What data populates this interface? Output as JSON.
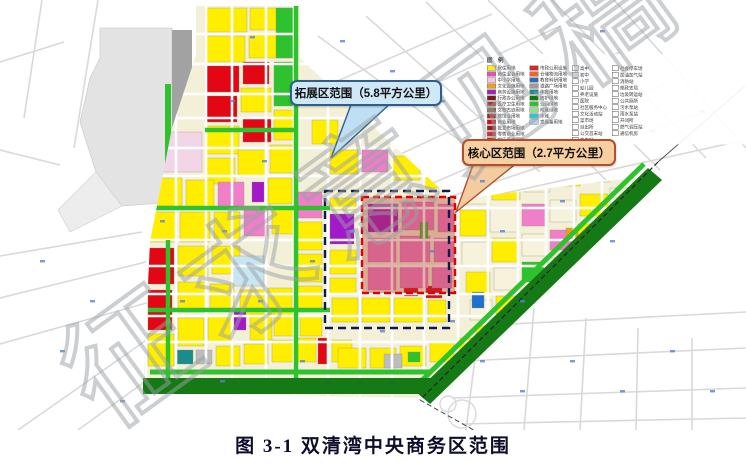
{
  "figure": {
    "caption": "图 3-1 双清湾中央商务区范围"
  },
  "callouts": {
    "expansion": {
      "label": "拓展区范围（5.8平方公里）",
      "area_km2": "5.8"
    },
    "core": {
      "label": "核心区范围（2.7平方公里）",
      "area_km2": "2.7"
    }
  },
  "watermark": {
    "text": "征求意见稿",
    "color": "#9aa0a6"
  },
  "legend": {
    "title": "图 例",
    "col1": [
      {
        "color": "#FFF200",
        "label": "居住用地"
      },
      {
        "color": "#E94FB0",
        "label": "商住混合用地"
      },
      {
        "color": "#F6C6DE",
        "label": "中小学用地"
      },
      {
        "color": "#F59B14",
        "label": "文化设施用地"
      },
      {
        "color": "#9B26B6",
        "label": "商务设施用地"
      },
      {
        "color": "#7A1A1A",
        "label": "行政办公用地"
      },
      {
        "color": "#A83232",
        "label": "医疗卫生用地"
      },
      {
        "color": "#8B5A2B",
        "label": "文物古迹用地"
      },
      {
        "color": "#B71C1C",
        "label": "旅馆业用地"
      },
      {
        "color": "#E30613",
        "label": "商业用地"
      },
      {
        "color": "#9E1B1B",
        "label": "批发市场用地"
      },
      {
        "color": "#D32F2F",
        "label": "零售商业用地"
      },
      {
        "color": "#C62828",
        "label": "娱乐康体用地"
      }
    ],
    "col2": [
      {
        "color": "#D42A2A",
        "label": "市政公用设施"
      },
      {
        "color": "#F26522",
        "label": "仓储物流用地"
      },
      {
        "color": "#2B6CB8",
        "label": "教育科研用地"
      },
      {
        "color": "#9C9C9C",
        "label": "道路广场用地"
      },
      {
        "color": "#1A8C8C",
        "label": "体育用地"
      },
      {
        "color": "#0E7A0E",
        "label": "防护绿地"
      },
      {
        "color": "#2EC22E",
        "label": "公园绿地"
      },
      {
        "color": "#8FE08F",
        "label": "附属绿地"
      },
      {
        "color": "#27C8C8",
        "label": "水域"
      },
      {
        "color": "#AFD8F2",
        "label": "发展备用地"
      }
    ],
    "col3": [
      "高中",
      "初中",
      "小学",
      "幼儿园",
      "养老设施",
      "医院",
      "社区服务中心",
      "文化活动站",
      "菜市场",
      "派出所",
      "公交首末站",
      "变电站"
    ],
    "col4": [
      "社会停车场",
      "加油加气站",
      "消防站",
      "邮政支局",
      "垃圾转运站",
      "公共厕所",
      "污水泵站",
      "雨水泵站",
      "开闭所",
      "燃气调压站",
      "通信机房"
    ]
  },
  "map": {
    "palette": {
      "Y": "#FFEE00",
      "R": "#E30613",
      "P": "#F07EC8",
      "LP": "#F3D5E8",
      "M": "#A318C9",
      "O": "#F59B14",
      "C": "#C8E6F0",
      "B": "#1F6FD0",
      "T": "#1A8C8C",
      "G": "#2EC22E",
      "DG": "#157A15",
      "K": "#BDBDBD",
      "CR": "#F6F2DC",
      "base": "#F4F0D8",
      "overlay": "#B03A2E",
      "navy": "#0B1B4A",
      "red_dash": "#E00000",
      "faint": "#d9d9d9",
      "tick": "#5B7FD4",
      "station": "#e3e3e3",
      "rail_strip": "#a2a2a2"
    },
    "planned_polygon": [
      [
        196,
        6
      ],
      [
        300,
        6
      ],
      [
        300,
        58
      ],
      [
        452,
        200
      ],
      [
        640,
        177
      ],
      [
        418,
        398
      ],
      [
        143,
        392
      ],
      [
        150,
        242
      ],
      [
        172,
        128
      ],
      [
        196,
        55
      ]
    ],
    "expansion_rect": [
      325,
      191,
      124,
      137
    ],
    "core_rect": [
      362,
      197,
      93,
      96
    ],
    "pointer_expansion": [
      [
        352,
        102
      ],
      [
        392,
        102
      ],
      [
        331,
        158
      ]
    ],
    "pointer_core": [
      [
        474,
        162
      ],
      [
        518,
        162
      ],
      [
        456,
        212
      ]
    ],
    "band_diagonal": [
      [
        648,
        168
      ],
      [
        662,
        180
      ],
      [
        430,
        404
      ],
      [
        416,
        392
      ]
    ],
    "band_bottom": [
      143,
      378,
      292,
      16
    ],
    "bright_edge_diag": [
      644,
      164,
      412,
      390
    ],
    "bright_edge_bottom": [
      150,
      372,
      430,
      372
    ],
    "railway": {
      "main": [
        658,
        162,
        420,
        400
      ],
      "ext_top": [
        658,
        162,
        745,
        86
      ],
      "ext_bottom": [
        420,
        400,
        545,
        470
      ]
    },
    "station_polygon": [
      [
        100,
        28
      ],
      [
        172,
        28
      ],
      [
        172,
        202
      ],
      [
        122,
        206
      ],
      [
        96,
        172
      ],
      [
        80,
        122
      ],
      [
        90,
        78
      ],
      [
        100,
        58
      ]
    ],
    "station_tail": [
      [
        96,
        172
      ],
      [
        122,
        206
      ],
      [
        70,
        232
      ],
      [
        58,
        210
      ]
    ],
    "station_rail_rect": [
      172,
      30,
      20,
      172
    ],
    "station_green_rect": [
      165,
      84,
      6,
      116
    ],
    "road_v_x": [
      146,
      176,
      206,
      232,
      266,
      294,
      328,
      360,
      392,
      424,
      458,
      488,
      518,
      546,
      574,
      602,
      630
    ],
    "road_h_y": [
      34,
      64,
      94,
      118,
      148,
      176,
      208,
      240,
      266,
      294,
      316,
      342
    ],
    "green_strips": [
      [
        296,
        6,
        296,
        390
      ],
      [
        168,
        240,
        168,
        390
      ],
      [
        205,
        130,
        298,
        130
      ],
      [
        148,
        208,
        330,
        208
      ],
      [
        148,
        310,
        330,
        310
      ]
    ],
    "parcels": [
      [
        205,
        8,
        42,
        24,
        "Y"
      ],
      [
        250,
        8,
        44,
        22,
        "Y"
      ],
      [
        205,
        36,
        40,
        26,
        "Y"
      ],
      [
        249,
        34,
        44,
        24,
        "Y"
      ],
      [
        276,
        8,
        18,
        50,
        "G"
      ],
      [
        205,
        66,
        34,
        26,
        "R"
      ],
      [
        243,
        62,
        26,
        22,
        "R"
      ],
      [
        205,
        96,
        32,
        26,
        "R"
      ],
      [
        241,
        88,
        30,
        24,
        "Y"
      ],
      [
        274,
        62,
        20,
        44,
        "G"
      ],
      [
        205,
        126,
        34,
        28,
        "Y"
      ],
      [
        243,
        118,
        28,
        24,
        "R"
      ],
      [
        274,
        110,
        22,
        30,
        "Y"
      ],
      [
        160,
        132,
        42,
        40,
        "LP"
      ],
      [
        205,
        158,
        30,
        26,
        "Y"
      ],
      [
        238,
        150,
        28,
        26,
        "Y"
      ],
      [
        270,
        145,
        26,
        28,
        "Y"
      ],
      [
        152,
        178,
        30,
        28,
        "Y"
      ],
      [
        186,
        180,
        28,
        28,
        "Y"
      ],
      [
        218,
        182,
        26,
        26,
        "P"
      ],
      [
        268,
        178,
        24,
        26,
        "Y"
      ],
      [
        252,
        182,
        12,
        20,
        "M"
      ],
      [
        148,
        212,
        28,
        30,
        "Y"
      ],
      [
        180,
        212,
        30,
        30,
        "Y"
      ],
      [
        214,
        212,
        26,
        28,
        "Y"
      ],
      [
        244,
        210,
        24,
        26,
        "P"
      ],
      [
        272,
        208,
        24,
        26,
        "Y"
      ],
      [
        148,
        248,
        26,
        36,
        "R"
      ],
      [
        148,
        290,
        24,
        40,
        "R"
      ],
      [
        178,
        246,
        30,
        30,
        "Y"
      ],
      [
        212,
        246,
        28,
        28,
        "Y"
      ],
      [
        232,
        256,
        32,
        30,
        "C"
      ],
      [
        178,
        282,
        28,
        30,
        "Y"
      ],
      [
        210,
        284,
        24,
        26,
        "Y"
      ],
      [
        240,
        290,
        26,
        26,
        "Y"
      ],
      [
        268,
        288,
        24,
        26,
        "Y"
      ],
      [
        148,
        334,
        26,
        32,
        "Y"
      ],
      [
        178,
        318,
        26,
        28,
        "Y"
      ],
      [
        208,
        316,
        24,
        26,
        "Y"
      ],
      [
        234,
        310,
        12,
        20,
        "M"
      ],
      [
        250,
        314,
        22,
        26,
        "Y"
      ],
      [
        274,
        312,
        22,
        24,
        "Y"
      ],
      [
        175,
        350,
        18,
        14,
        "T"
      ],
      [
        196,
        350,
        16,
        14,
        "K"
      ],
      [
        216,
        346,
        24,
        20,
        "Y"
      ],
      [
        244,
        344,
        24,
        20,
        "Y"
      ],
      [
        272,
        340,
        22,
        22,
        "Y"
      ],
      [
        298,
        338,
        18,
        24,
        "Y"
      ],
      [
        318,
        338,
        10,
        26,
        "R"
      ],
      [
        332,
        340,
        20,
        22,
        "Y"
      ],
      [
        298,
        192,
        24,
        26,
        "P"
      ],
      [
        298,
        222,
        24,
        28,
        "Y"
      ],
      [
        298,
        254,
        24,
        28,
        "Y"
      ],
      [
        298,
        286,
        24,
        26,
        "Y"
      ],
      [
        300,
        316,
        22,
        20,
        "Y"
      ],
      [
        312,
        120,
        26,
        24,
        "Y"
      ],
      [
        330,
        150,
        28,
        24,
        "Y"
      ],
      [
        362,
        150,
        26,
        22,
        "P"
      ],
      [
        392,
        156,
        28,
        24,
        "Y"
      ],
      [
        424,
        168,
        24,
        20,
        "Y"
      ],
      [
        330,
        198,
        26,
        12,
        "Y"
      ],
      [
        330,
        214,
        24,
        30,
        "M"
      ],
      [
        330,
        250,
        26,
        24,
        "Y"
      ],
      [
        330,
        278,
        26,
        16,
        "Y"
      ],
      [
        332,
        298,
        26,
        24,
        "Y"
      ],
      [
        362,
        298,
        28,
        24,
        "Y"
      ],
      [
        394,
        298,
        30,
        24,
        "Y"
      ],
      [
        426,
        286,
        16,
        12,
        "R"
      ],
      [
        428,
        300,
        18,
        22,
        "Y"
      ],
      [
        368,
        204,
        30,
        28,
        "M"
      ],
      [
        402,
        202,
        32,
        28,
        "P"
      ],
      [
        438,
        204,
        16,
        28,
        "P"
      ],
      [
        368,
        238,
        28,
        24,
        "P"
      ],
      [
        400,
        236,
        30,
        26,
        "P"
      ],
      [
        434,
        238,
        20,
        24,
        "P"
      ],
      [
        368,
        266,
        28,
        24,
        "P"
      ],
      [
        400,
        266,
        28,
        22,
        "P"
      ],
      [
        432,
        266,
        20,
        22,
        "P"
      ],
      [
        404,
        288,
        14,
        8,
        "R"
      ],
      [
        420,
        222,
        8,
        18,
        "G"
      ],
      [
        462,
        180,
        26,
        24,
        "CR"
      ],
      [
        492,
        176,
        28,
        24,
        "Y"
      ],
      [
        524,
        170,
        26,
        22,
        "CR"
      ],
      [
        554,
        166,
        26,
        20,
        "Y"
      ],
      [
        584,
        162,
        26,
        20,
        "CR"
      ],
      [
        612,
        158,
        26,
        18,
        "Y"
      ],
      [
        558,
        166,
        10,
        12,
        "R"
      ],
      [
        460,
        210,
        26,
        26,
        "Y"
      ],
      [
        490,
        208,
        28,
        24,
        "CR"
      ],
      [
        522,
        204,
        24,
        22,
        "P"
      ],
      [
        550,
        200,
        26,
        22,
        "CR"
      ],
      [
        580,
        194,
        28,
        22,
        "Y"
      ],
      [
        610,
        188,
        24,
        20,
        "CR"
      ],
      [
        462,
        242,
        26,
        24,
        "CR"
      ],
      [
        492,
        238,
        26,
        24,
        "Y"
      ],
      [
        522,
        234,
        24,
        22,
        "CR"
      ],
      [
        550,
        230,
        24,
        20,
        "P"
      ],
      [
        578,
        224,
        26,
        22,
        "Y"
      ],
      [
        606,
        218,
        22,
        20,
        "CR"
      ],
      [
        566,
        228,
        12,
        10,
        "O"
      ],
      [
        466,
        272,
        24,
        22,
        "Y"
      ],
      [
        494,
        268,
        24,
        22,
        "CR"
      ],
      [
        522,
        262,
        22,
        20,
        "G"
      ],
      [
        548,
        258,
        24,
        20,
        "CR"
      ],
      [
        574,
        252,
        24,
        20,
        "Y"
      ],
      [
        600,
        248,
        20,
        18,
        "CR"
      ],
      [
        470,
        300,
        22,
        20,
        "CR"
      ],
      [
        496,
        296,
        22,
        18,
        "Y"
      ],
      [
        522,
        290,
        20,
        18,
        "CR"
      ],
      [
        546,
        286,
        22,
        18,
        "Y"
      ],
      [
        472,
        292,
        12,
        16,
        "B"
      ],
      [
        476,
        326,
        20,
        16,
        "Y"
      ],
      [
        500,
        322,
        20,
        16,
        "CR"
      ],
      [
        524,
        316,
        18,
        14,
        "Y"
      ],
      [
        338,
        348,
        28,
        20,
        "Y"
      ],
      [
        370,
        348,
        26,
        20,
        "Y"
      ],
      [
        400,
        346,
        26,
        20,
        "Y"
      ],
      [
        430,
        342,
        24,
        20,
        "Y"
      ],
      [
        458,
        338,
        24,
        18,
        "Y"
      ],
      [
        486,
        332,
        22,
        18,
        "Y"
      ],
      [
        384,
        354,
        18,
        14,
        "K"
      ],
      [
        408,
        352,
        12,
        10,
        "G"
      ]
    ],
    "faint_roads": [
      [
        312,
        92,
        492,
        14
      ],
      [
        330,
        132,
        560,
        26
      ],
      [
        362,
        172,
        620,
        52
      ],
      [
        398,
        198,
        668,
        82
      ],
      [
        446,
        198,
        706,
        112
      ],
      [
        492,
        196,
        745,
        140
      ],
      [
        318,
        36,
        470,
        148
      ],
      [
        366,
        16,
        540,
        172
      ],
      [
        426,
        2,
        606,
        180
      ],
      [
        488,
        0,
        660,
        170
      ],
      [
        552,
        0,
        706,
        158
      ],
      [
        614,
        0,
        746,
        148
      ],
      [
        482,
        302,
        466,
        430
      ],
      [
        534,
        308,
        524,
        430
      ],
      [
        586,
        318,
        580,
        430
      ],
      [
        638,
        328,
        636,
        430
      ],
      [
        692,
        338,
        692,
        430
      ],
      [
        434,
        328,
        746,
        312
      ],
      [
        442,
        362,
        746,
        348
      ],
      [
        452,
        398,
        746,
        388
      ],
      [
        462,
        424,
        746,
        418
      ],
      [
        0,
        298,
        146,
        262
      ],
      [
        0,
        344,
        150,
        302
      ],
      [
        18,
        430,
        158,
        332
      ],
      [
        78,
        430,
        172,
        362
      ],
      [
        0,
        256,
        142,
        232
      ],
      [
        42,
        0,
        24,
        118
      ],
      [
        98,
        0,
        74,
        148
      ],
      [
        0,
        62,
        64,
        42
      ],
      [
        0,
        150,
        60,
        165
      ]
    ],
    "interchange_circles": [
      [
        448,
        404,
        8
      ],
      [
        462,
        414,
        14
      ]
    ],
    "blue_ticks": [
      [
        250,
        36
      ],
      [
        230,
        100
      ],
      [
        262,
        160
      ],
      [
        222,
        230
      ],
      [
        258,
        300
      ],
      [
        350,
        230
      ],
      [
        310,
        260
      ],
      [
        430,
        250
      ],
      [
        500,
        230
      ],
      [
        560,
        200
      ],
      [
        610,
        240
      ],
      [
        480,
        180
      ],
      [
        520,
        300
      ],
      [
        450,
        320
      ],
      [
        380,
        330
      ],
      [
        300,
        360
      ],
      [
        220,
        380
      ],
      [
        180,
        300
      ],
      [
        160,
        220
      ],
      [
        340,
        40
      ],
      [
        390,
        70
      ],
      [
        440,
        100
      ],
      [
        490,
        130
      ],
      [
        540,
        60
      ],
      [
        600,
        30
      ],
      [
        650,
        130
      ],
      [
        700,
        110
      ],
      [
        480,
        360
      ],
      [
        520,
        390
      ],
      [
        570,
        360
      ],
      [
        620,
        390
      ],
      [
        670,
        350
      ],
      [
        710,
        390
      ],
      [
        90,
        300
      ],
      [
        60,
        350
      ],
      [
        120,
        400
      ],
      [
        40,
        260
      ]
    ]
  }
}
